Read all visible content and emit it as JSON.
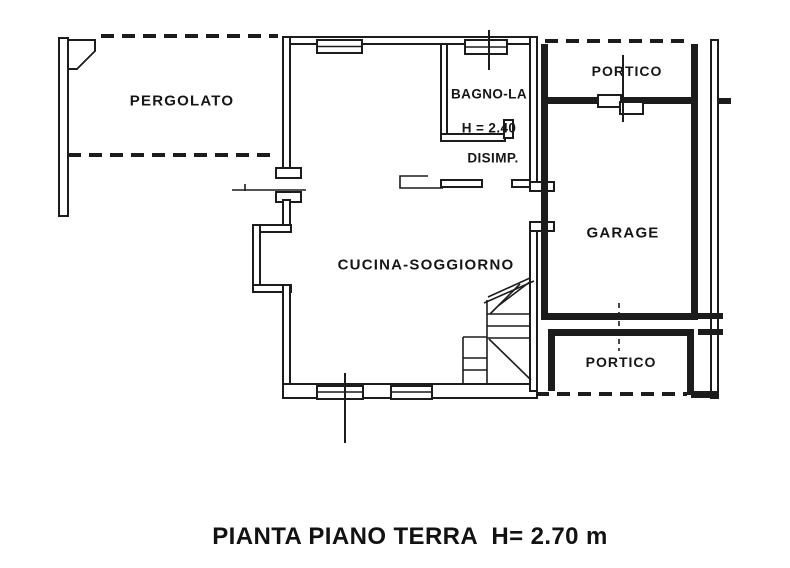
{
  "drawing": {
    "type": "floor-plan",
    "ink_color": "#1c1c1c",
    "background": "#ffffff",
    "rooms": {
      "pergolato": "PERGOLATO",
      "bagno": "BAGNO-LA",
      "bagno_height": "H = 2.40",
      "disimpegno": "DISIMP.",
      "cucina": "CUCINA-SOGGIORNO",
      "garage": "GARAGE",
      "portico_top": "PORTICO",
      "portico_bottom": "PORTICO"
    },
    "caption": "PIANTA PIANO TERRA  H= 2.70 m"
  }
}
